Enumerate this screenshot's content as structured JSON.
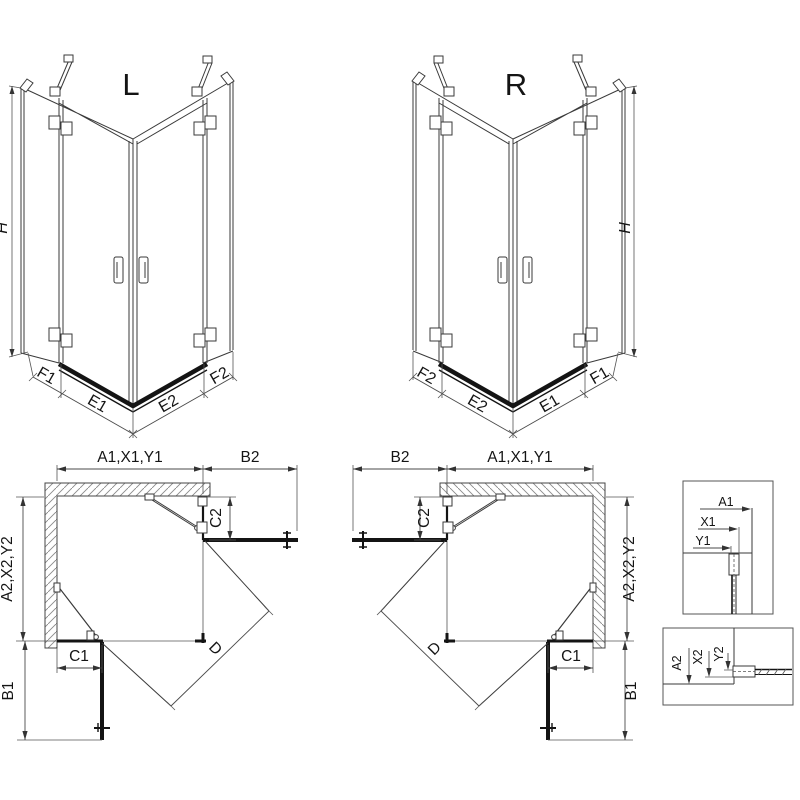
{
  "front_view_left": {
    "view_label": "L",
    "height_dim": "H",
    "base_dims": {
      "f1": "F1",
      "e1": "E1",
      "e2": "E2",
      "f2": "F2"
    }
  },
  "front_view_right": {
    "view_label": "R",
    "height_dim": "H",
    "base_dims": {
      "f1": "F1",
      "e1": "E1",
      "e2": "E2",
      "f2": "F2"
    }
  },
  "plan_view_left": {
    "width_dim": "A1,X1,Y1",
    "side_screen_dim_top": "B2",
    "wall_offset_dim_right": "C2",
    "depth_dim": "A2,X2,Y2",
    "wall_offset_dim_bottom": "C1",
    "side_screen_dim_bottom": "B1",
    "diagonal_dim": "D"
  },
  "plan_view_right": {
    "width_dim": "A1,X1,Y1",
    "side_screen_dim_top": "B2",
    "wall_offset_dim_right": "C2",
    "depth_dim": "A2,X2,Y2",
    "wall_offset_dim_bottom": "C1",
    "side_screen_dim_bottom": "B1",
    "diagonal_dim": "D"
  },
  "detail_view_top": {
    "dims": [
      "A1",
      "X1",
      "Y1"
    ]
  },
  "detail_view_bottom": {
    "dims": [
      "A2",
      "X2",
      "Y2"
    ]
  },
  "colors": {
    "line": "#3a3a3a",
    "dark": "#141414",
    "dim_line": "#555555",
    "hatch": "#8a8a8a",
    "background": "#ffffff"
  }
}
